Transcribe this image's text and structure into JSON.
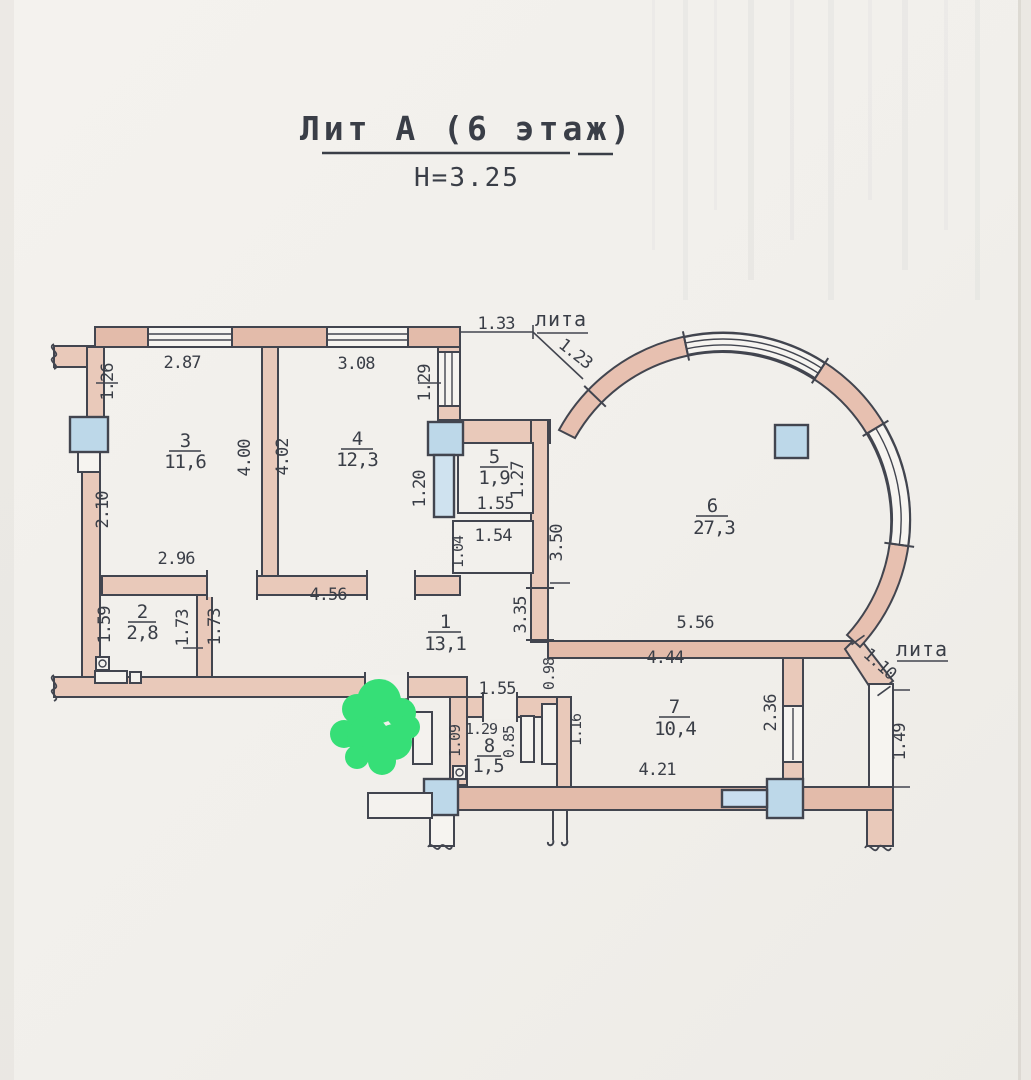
{
  "title": {
    "main": "Лит А (6 этаж)",
    "height": "Н=3.25"
  },
  "labels": {
    "lita_top": "лита",
    "lita_right": "лита"
  },
  "rooms": [
    {
      "number": "1",
      "area": "13,1"
    },
    {
      "number": "2",
      "area": "2,8"
    },
    {
      "number": "3",
      "area": "11,6"
    },
    {
      "number": "4",
      "area": "12,3"
    },
    {
      "number": "5",
      "area": "1,9"
    },
    {
      "number": "6",
      "area": "27,3"
    },
    {
      "number": "7",
      "area": "10,4"
    },
    {
      "number": "8",
      "area": "1,5"
    }
  ],
  "dims": [
    {
      "v": "1.26"
    },
    {
      "v": "2.87"
    },
    {
      "v": "3.08"
    },
    {
      "v": "1.29"
    },
    {
      "v": "1.33"
    },
    {
      "v": "1.23"
    },
    {
      "v": "2.10"
    },
    {
      "v": "4.00"
    },
    {
      "v": "4.02"
    },
    {
      "v": "1.20"
    },
    {
      "v": "1.27"
    },
    {
      "v": "1.55"
    },
    {
      "v": "1.54"
    },
    {
      "v": "1.04"
    },
    {
      "v": "3.50"
    },
    {
      "v": "2.96"
    },
    {
      "v": "4.56"
    },
    {
      "v": "1.59"
    },
    {
      "v": "1.73"
    },
    {
      "v": "1.73"
    },
    {
      "v": "3.35"
    },
    {
      "v": "0.98"
    },
    {
      "v": "5.56"
    },
    {
      "v": "4.44"
    },
    {
      "v": "1.10"
    },
    {
      "v": "2.36"
    },
    {
      "v": "1.16"
    },
    {
      "v": "1.55"
    },
    {
      "v": "1.29"
    },
    {
      "v": "0.85"
    },
    {
      "v": "1.09"
    },
    {
      "v": "4.21"
    },
    {
      "v": "1.49"
    }
  ],
  "colors": {
    "paper": "#f2f0ec",
    "wall_fill": "#e9c9ba",
    "wall_fill_dark": "#e2b8a7",
    "line": "#42454f",
    "column_fill": "#bdd8e9",
    "marker_green": "#36df77",
    "text": "#3a3e47"
  }
}
